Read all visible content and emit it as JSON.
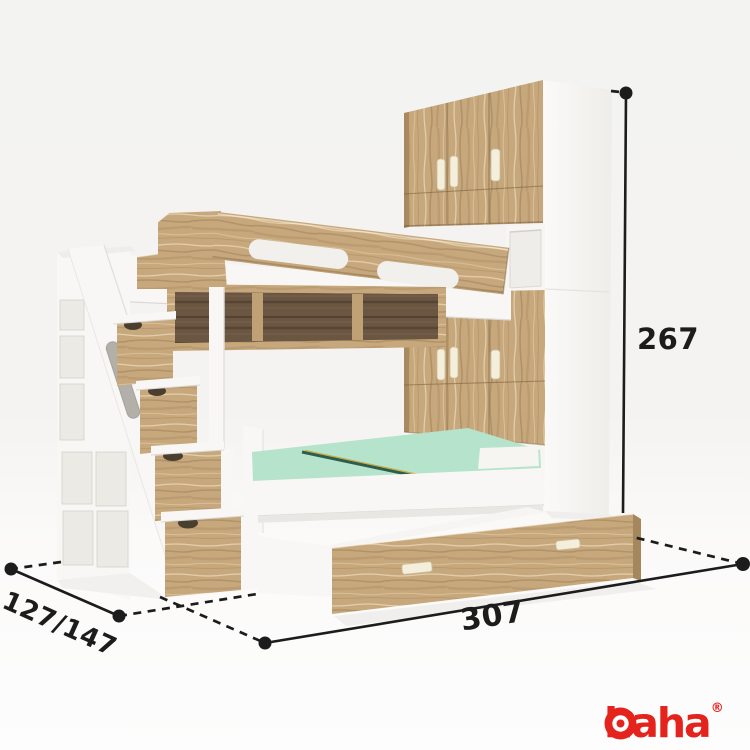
{
  "dimensions": {
    "height": "267",
    "depth": "127/147",
    "width": "307"
  },
  "logo": {
    "text": "Ohaha",
    "text_rest": "haha",
    "registered": "®",
    "icon": "target-circle-o"
  },
  "theme": {
    "bg-top": "#f3f3f1",
    "bg-bottom": "#fdfdfd",
    "wood": "#c7a87c",
    "wood-dark": "#6b5642",
    "wood-edge": "#a98a5f",
    "furniture-white": "#f8f7f5",
    "mattress": "#b5e3cc",
    "dim-line": "#1c1c1c",
    "logo-red": "#e3231c"
  }
}
